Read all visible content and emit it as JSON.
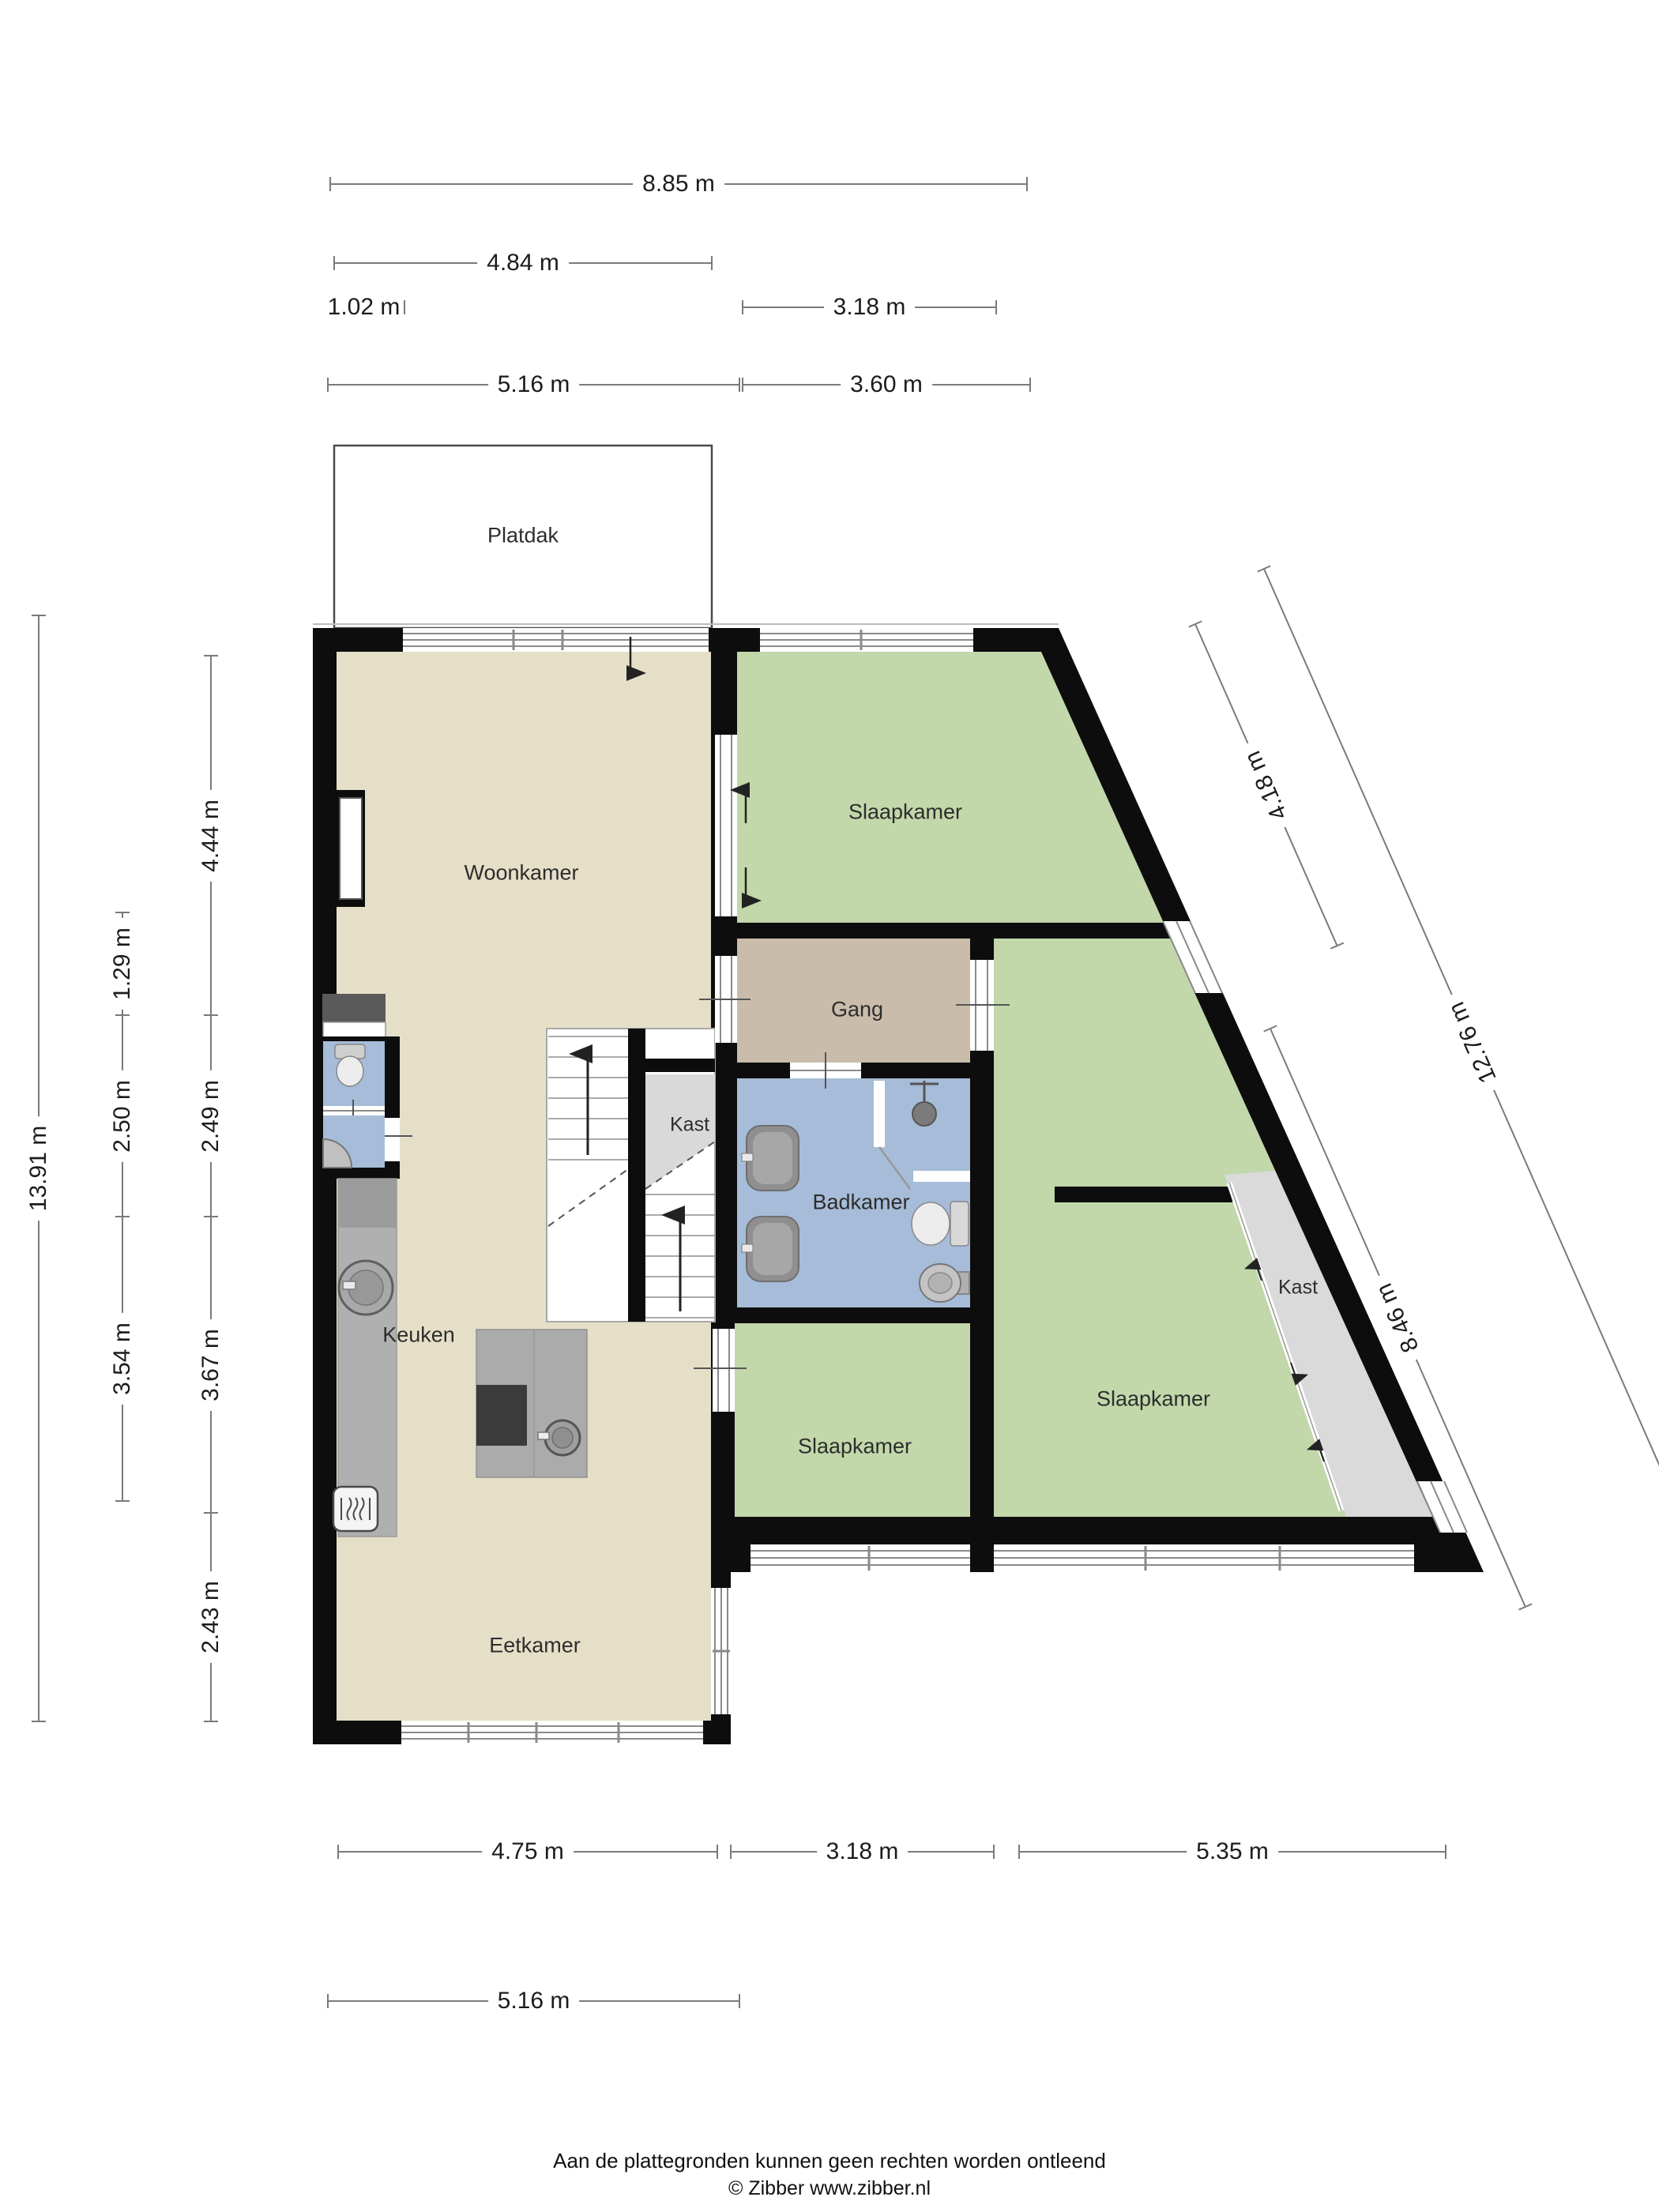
{
  "rooms": {
    "platdak": {
      "label": "Platdak"
    },
    "woonkamer": {
      "label": "Woonkamer"
    },
    "slaapkamer_top": {
      "label": "Slaapkamer"
    },
    "gang": {
      "label": "Gang"
    },
    "kast_stairs": {
      "label": "Kast"
    },
    "badkamer": {
      "label": "Badkamer"
    },
    "keuken": {
      "label": "Keuken"
    },
    "eetkamer": {
      "label": "Eetkamer"
    },
    "slaapkamer_mid": {
      "label": "Slaapkamer"
    },
    "slaapkamer_right": {
      "label": "Slaapkamer"
    },
    "kast_right": {
      "label": "Kast"
    }
  },
  "dimensions": {
    "top": [
      {
        "label": "8.85 m"
      },
      {
        "label": "4.84 m"
      },
      {
        "label": "1.02 m"
      },
      {
        "label": "3.18 m"
      },
      {
        "label": "5.16 m"
      },
      {
        "label": "3.60 m"
      }
    ],
    "left": [
      {
        "label": "13.91 m"
      },
      {
        "label": "4.44 m"
      },
      {
        "label": "1.29 m"
      },
      {
        "label": "2.50 m"
      },
      {
        "label": "2.49 m"
      },
      {
        "label": "3.54 m"
      },
      {
        "label": "3.67 m"
      },
      {
        "label": "2.43 m"
      }
    ],
    "right_diagonal": [
      {
        "label": "4.18 m"
      },
      {
        "label": "12.76 m"
      },
      {
        "label": "8.46 m"
      }
    ],
    "bottom": [
      {
        "label": "4.75 m"
      },
      {
        "label": "3.18 m"
      },
      {
        "label": "5.35 m"
      },
      {
        "label": "5.16 m"
      }
    ]
  },
  "footer": {
    "disclaimer": "Aan de plattegronden kunnen geen rechten worden ontleend",
    "copyright": "© Zibber www.zibber.nl"
  },
  "colors": {
    "wall": "#0d0d0d",
    "floor_living": "#e6dfc8",
    "floor_bedroom": "#c2d7aa",
    "floor_hall": "#c9bcab",
    "floor_bath": "#a6bcd8",
    "floor_closet": "#dadada",
    "window_line": "#8a8a8a"
  }
}
